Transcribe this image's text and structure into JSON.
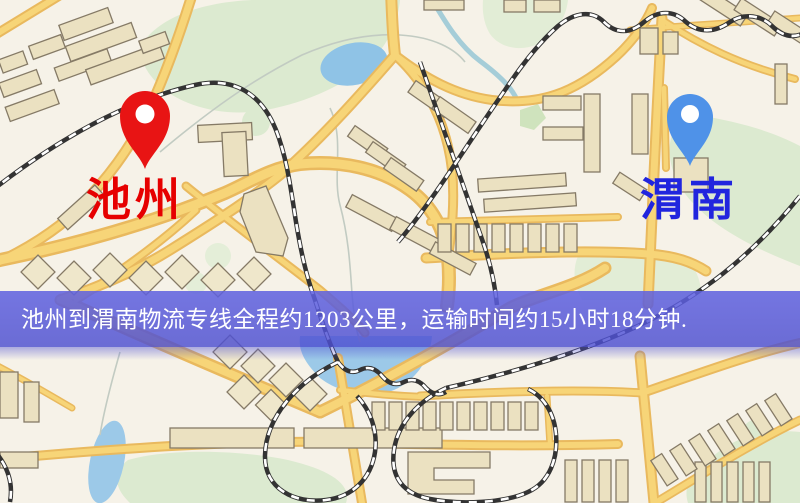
{
  "banner": {
    "text": "池州到渭南物流专线全程约1203公里，运输时间约15小时18分钟.",
    "background_color": "#5456d6",
    "text_color": "#ffffff"
  },
  "route": {
    "origin": "池州",
    "destination": "渭南",
    "distance_text": "约1203公里",
    "duration_text": "约15小时18分钟"
  },
  "markers": [
    {
      "role": "origin",
      "label": "池州",
      "label_color": "#e60000",
      "pin_color": "#e81414",
      "icon": "map-pin-icon"
    },
    {
      "role": "destination",
      "label": "渭南",
      "label_color": "#2125de",
      "pin_color": "#4f92e8",
      "icon": "map-pin-icon"
    }
  ],
  "map_palette": {
    "background": "#f6f2e8",
    "road_casing": "#e9b95e",
    "road_core": "#f7d578",
    "railway": "#333333",
    "building_fill": "#ebe1c1",
    "park": "#dcead0",
    "water": "#8fc3e6"
  }
}
